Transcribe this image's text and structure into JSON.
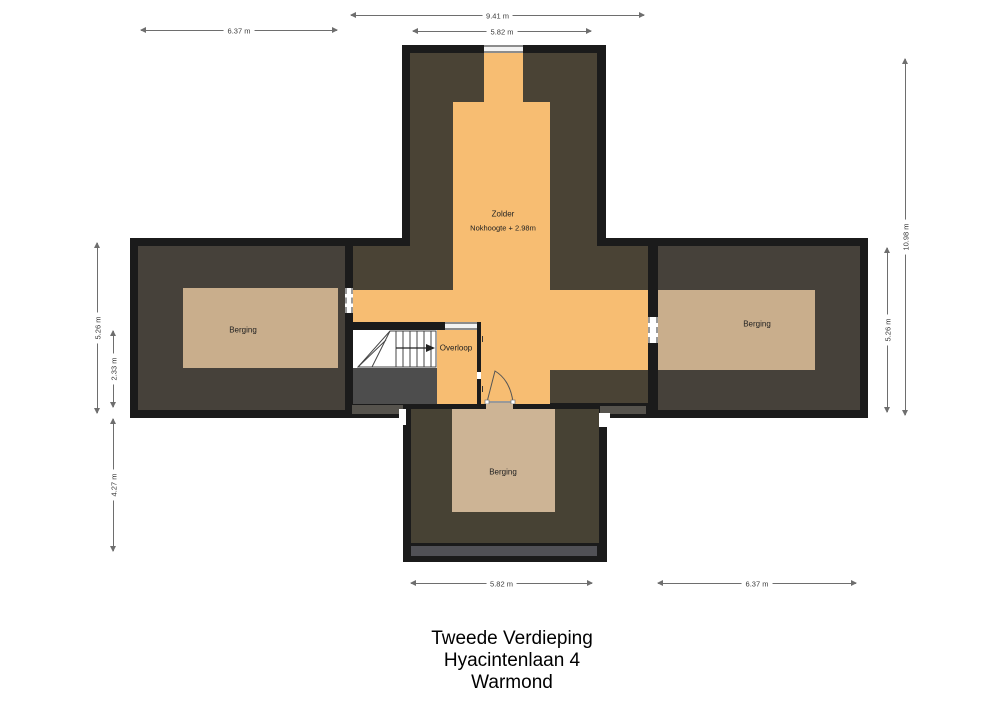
{
  "title": {
    "lines": [
      "Tweede Verdieping",
      "Hyacintenlaan 4",
      "Warmond"
    ]
  },
  "rooms": {
    "zolder": {
      "label": "Zolder",
      "sublabel": "Nokhoogte + 2.98m"
    },
    "overloop": {
      "label": "Overloop"
    },
    "berging_left": {
      "label": "Berging"
    },
    "berging_right": {
      "label": "Berging"
    },
    "berging_bottom": {
      "label": "Berging"
    }
  },
  "dimensions": {
    "top_total": "9.41 m",
    "top_inner": "5.82 m",
    "top_left": "6.37 m",
    "left_bar": "5.26 m",
    "left_stair": "2.33 m",
    "left_lower": "4.27 m",
    "right_total": "10.98 m",
    "right_bar": "5.26 m",
    "bottom_center": "5.82 m",
    "bottom_right": "6.37 m"
  },
  "colors": {
    "wall": "#1b1b1b",
    "roof_dark_top": "#4a4335",
    "roof_dark_side": "#46413a",
    "roof_dark_bottom": "#474234",
    "floor_orange": "#f7bd72",
    "floor_tan": "#c9ae8c",
    "floor_tan_bottom": "#cdb495",
    "void_gray": "#4d4d4d",
    "strip_gray": "#56534d",
    "dormer_strip": "#515156",
    "dim_line": "#6e6e6e",
    "label_text": "#222222"
  }
}
